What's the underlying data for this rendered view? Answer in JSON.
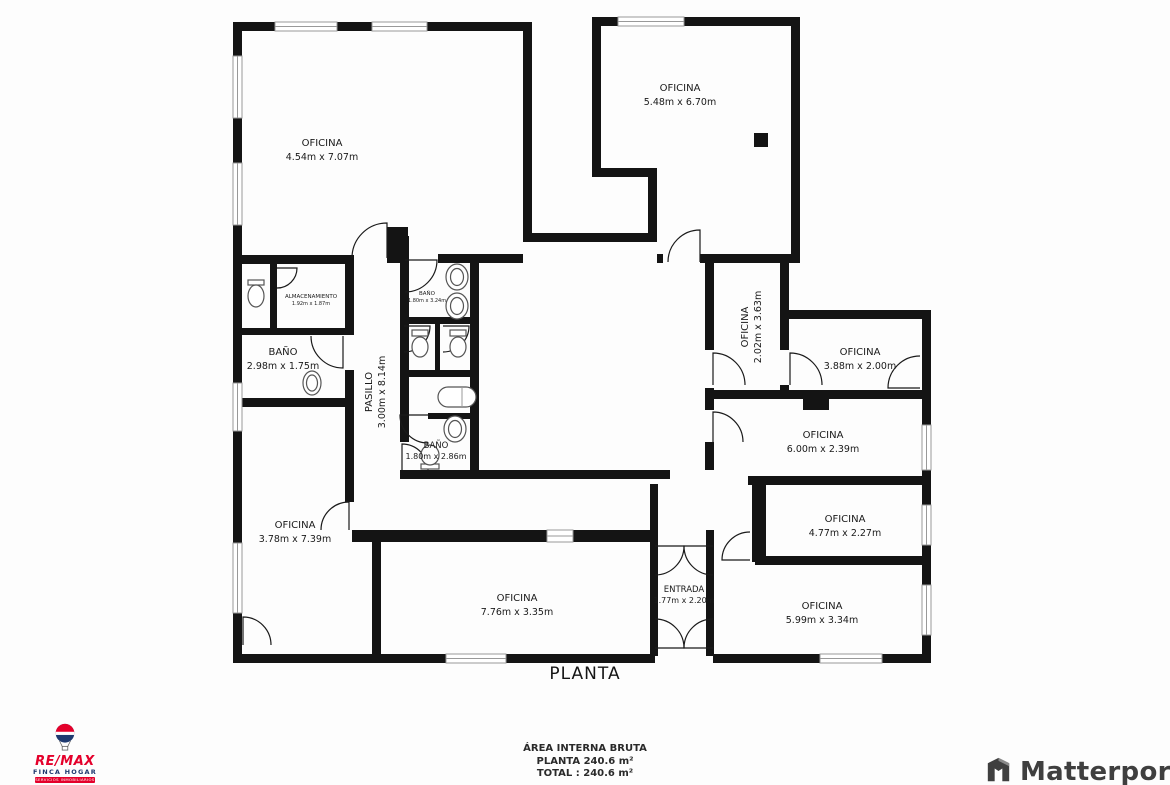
{
  "plan": {
    "title": "PLANTA",
    "rooms": {
      "office_tl": {
        "name": "OFICINA",
        "dims": "4.54m x 7.07m"
      },
      "office_tr": {
        "name": "OFICINA",
        "dims": "5.48m x 6.70m"
      },
      "storage": {
        "name": "ALMACENAMIENTO",
        "dims": "1.92m x 1.87m"
      },
      "bath_top": {
        "name": "BAÑO",
        "dims": "1.80m x 3.24m"
      },
      "bath_left": {
        "name": "BAÑO",
        "dims": "2.98m x 1.75m"
      },
      "hallway": {
        "name": "PASILLO",
        "dims": "3.00m x 8.14m"
      },
      "bath_bottom": {
        "name": "BAÑO",
        "dims": "1.80m x 2.86m"
      },
      "office_vert": {
        "name": "OFICINA",
        "dims": "2.02m x 3.63m"
      },
      "office_388": {
        "name": "OFICINA",
        "dims": "3.88m x 2.00m"
      },
      "office_600": {
        "name": "OFICINA",
        "dims": "6.00m x 2.39m"
      },
      "office_477": {
        "name": "OFICINA",
        "dims": "4.77m x 2.27m"
      },
      "entrance": {
        "name": "ENTRADA",
        "dims": "1.77m x 2.20m"
      },
      "office_599": {
        "name": "OFICINA",
        "dims": "5.99m x 3.34m"
      },
      "office_378": {
        "name": "OFICINA",
        "dims": "3.78m x 7.39m"
      },
      "office_776": {
        "name": "OFICINA",
        "dims": "7.76m x 3.35m"
      }
    }
  },
  "footer": {
    "area_label": "ÁREA INTERNA BRUTA",
    "planta_line": "PLANTA 240.6 m²",
    "total_line": "TOTAL :  240.6 m²"
  },
  "branding": {
    "remax": {
      "wordmark": "RE/MAX",
      "sub": "FINCA HOGAR",
      "tagline": "SERVICIOS INMOBILIARIOS"
    },
    "matterport": {
      "wordmark": "Matterport"
    }
  },
  "colors": {
    "wall": "#141414",
    "remax_red": "#e4002b",
    "remax_blue": "#1f3a70",
    "matterport_gray": "#3f3f3f"
  }
}
